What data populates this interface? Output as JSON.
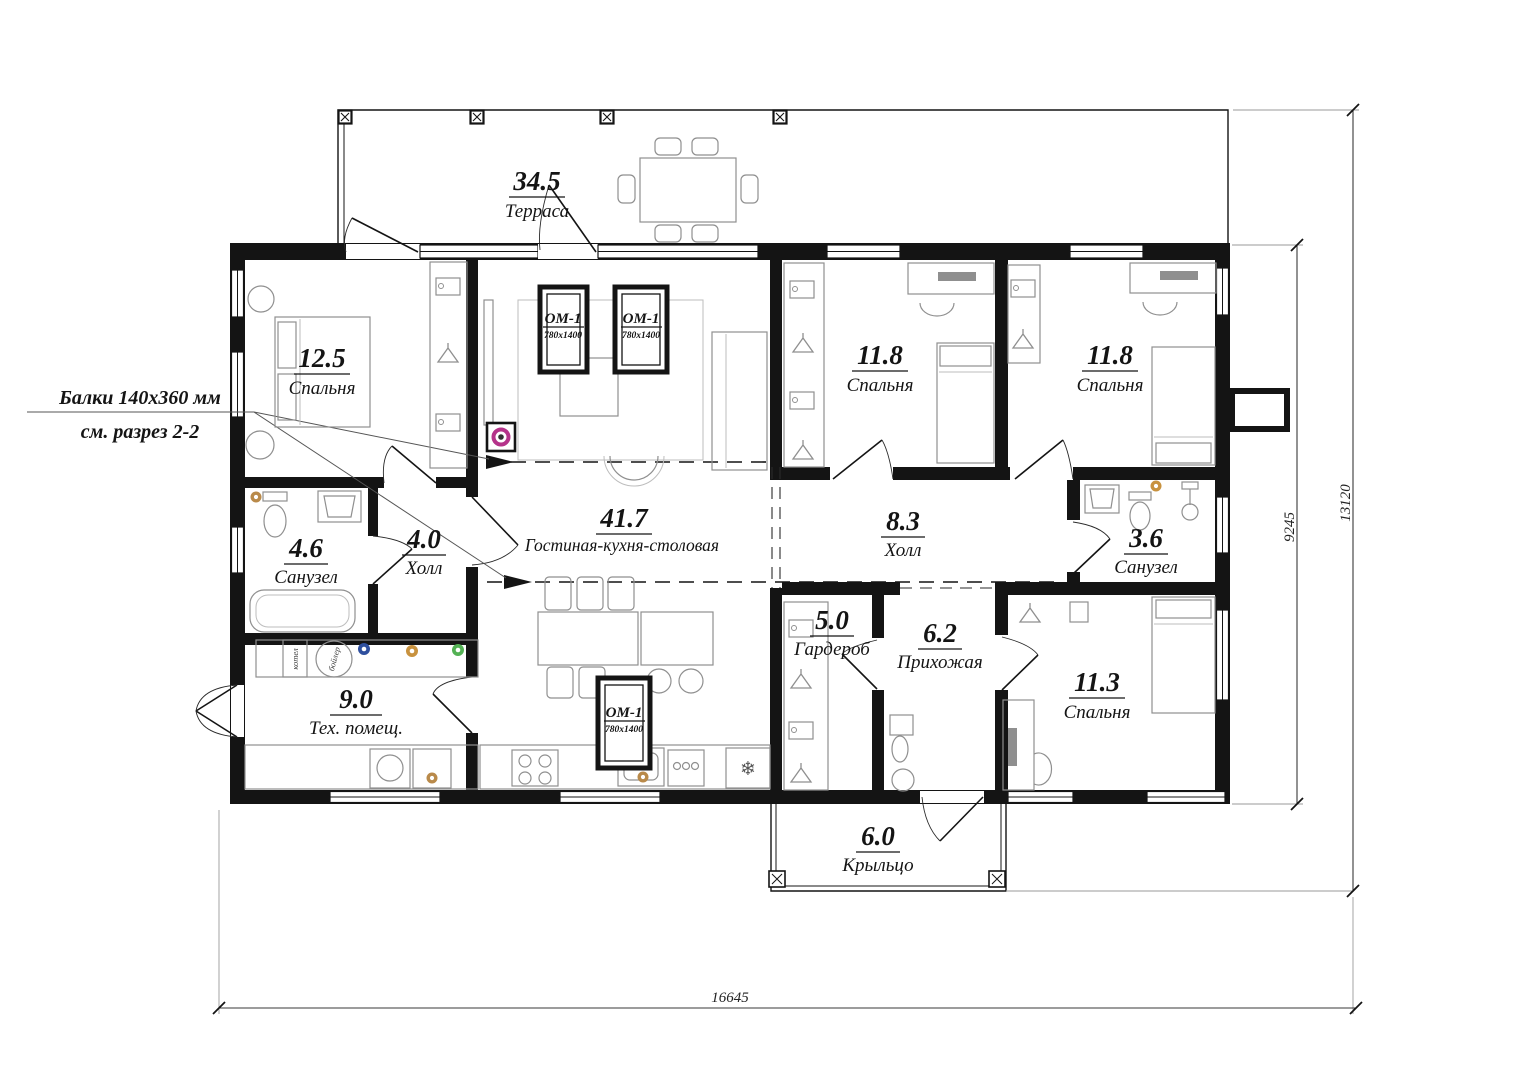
{
  "rooms": {
    "terrace": {
      "area": "34.5",
      "name": "Терраса"
    },
    "bedroom1": {
      "area": "12.5",
      "name": "Спальня"
    },
    "bath1": {
      "area": "4.6",
      "name": "Санузел"
    },
    "hall1": {
      "area": "4.0",
      "name": "Холл"
    },
    "living": {
      "area": "41.7",
      "name": "Гостиная-кухня-столовая"
    },
    "bedroom2": {
      "area": "11.8",
      "name": "Спальня"
    },
    "bedroom3": {
      "area": "11.8",
      "name": "Спальня"
    },
    "hall2": {
      "area": "8.3",
      "name": "Холл"
    },
    "bath2": {
      "area": "3.6",
      "name": "Санузел"
    },
    "wardrobe": {
      "area": "5.0",
      "name": "Гардероб"
    },
    "entry": {
      "area": "6.2",
      "name": "Прихожая"
    },
    "bedroom4": {
      "area": "11.3",
      "name": "Спальня"
    },
    "tech": {
      "area": "9.0",
      "name": "Тех. помещ."
    },
    "porch": {
      "area": "6.0",
      "name": "Крыльцо"
    }
  },
  "annotation": {
    "line1": "Балки 140x360 мм",
    "line2": "см. разрез 2-2"
  },
  "roof_window": {
    "label": "ОМ-1",
    "size": "780x1400"
  },
  "dimensions": {
    "width": "16645",
    "depth_inner": "9245",
    "depth_outer": "13120"
  },
  "equipment": {
    "boiler": "бойлер",
    "kotel": "котел",
    "fridge_symbol": "❄"
  },
  "colors": {
    "wall": "#141414",
    "furniture": "#8f8f8f",
    "accent_magenta": "#b5338a",
    "dot_blue": "#2e4f9e",
    "dot_orange": "#c8923f",
    "dot_green": "#53b154",
    "dot_tan": "#b98a4a"
  }
}
